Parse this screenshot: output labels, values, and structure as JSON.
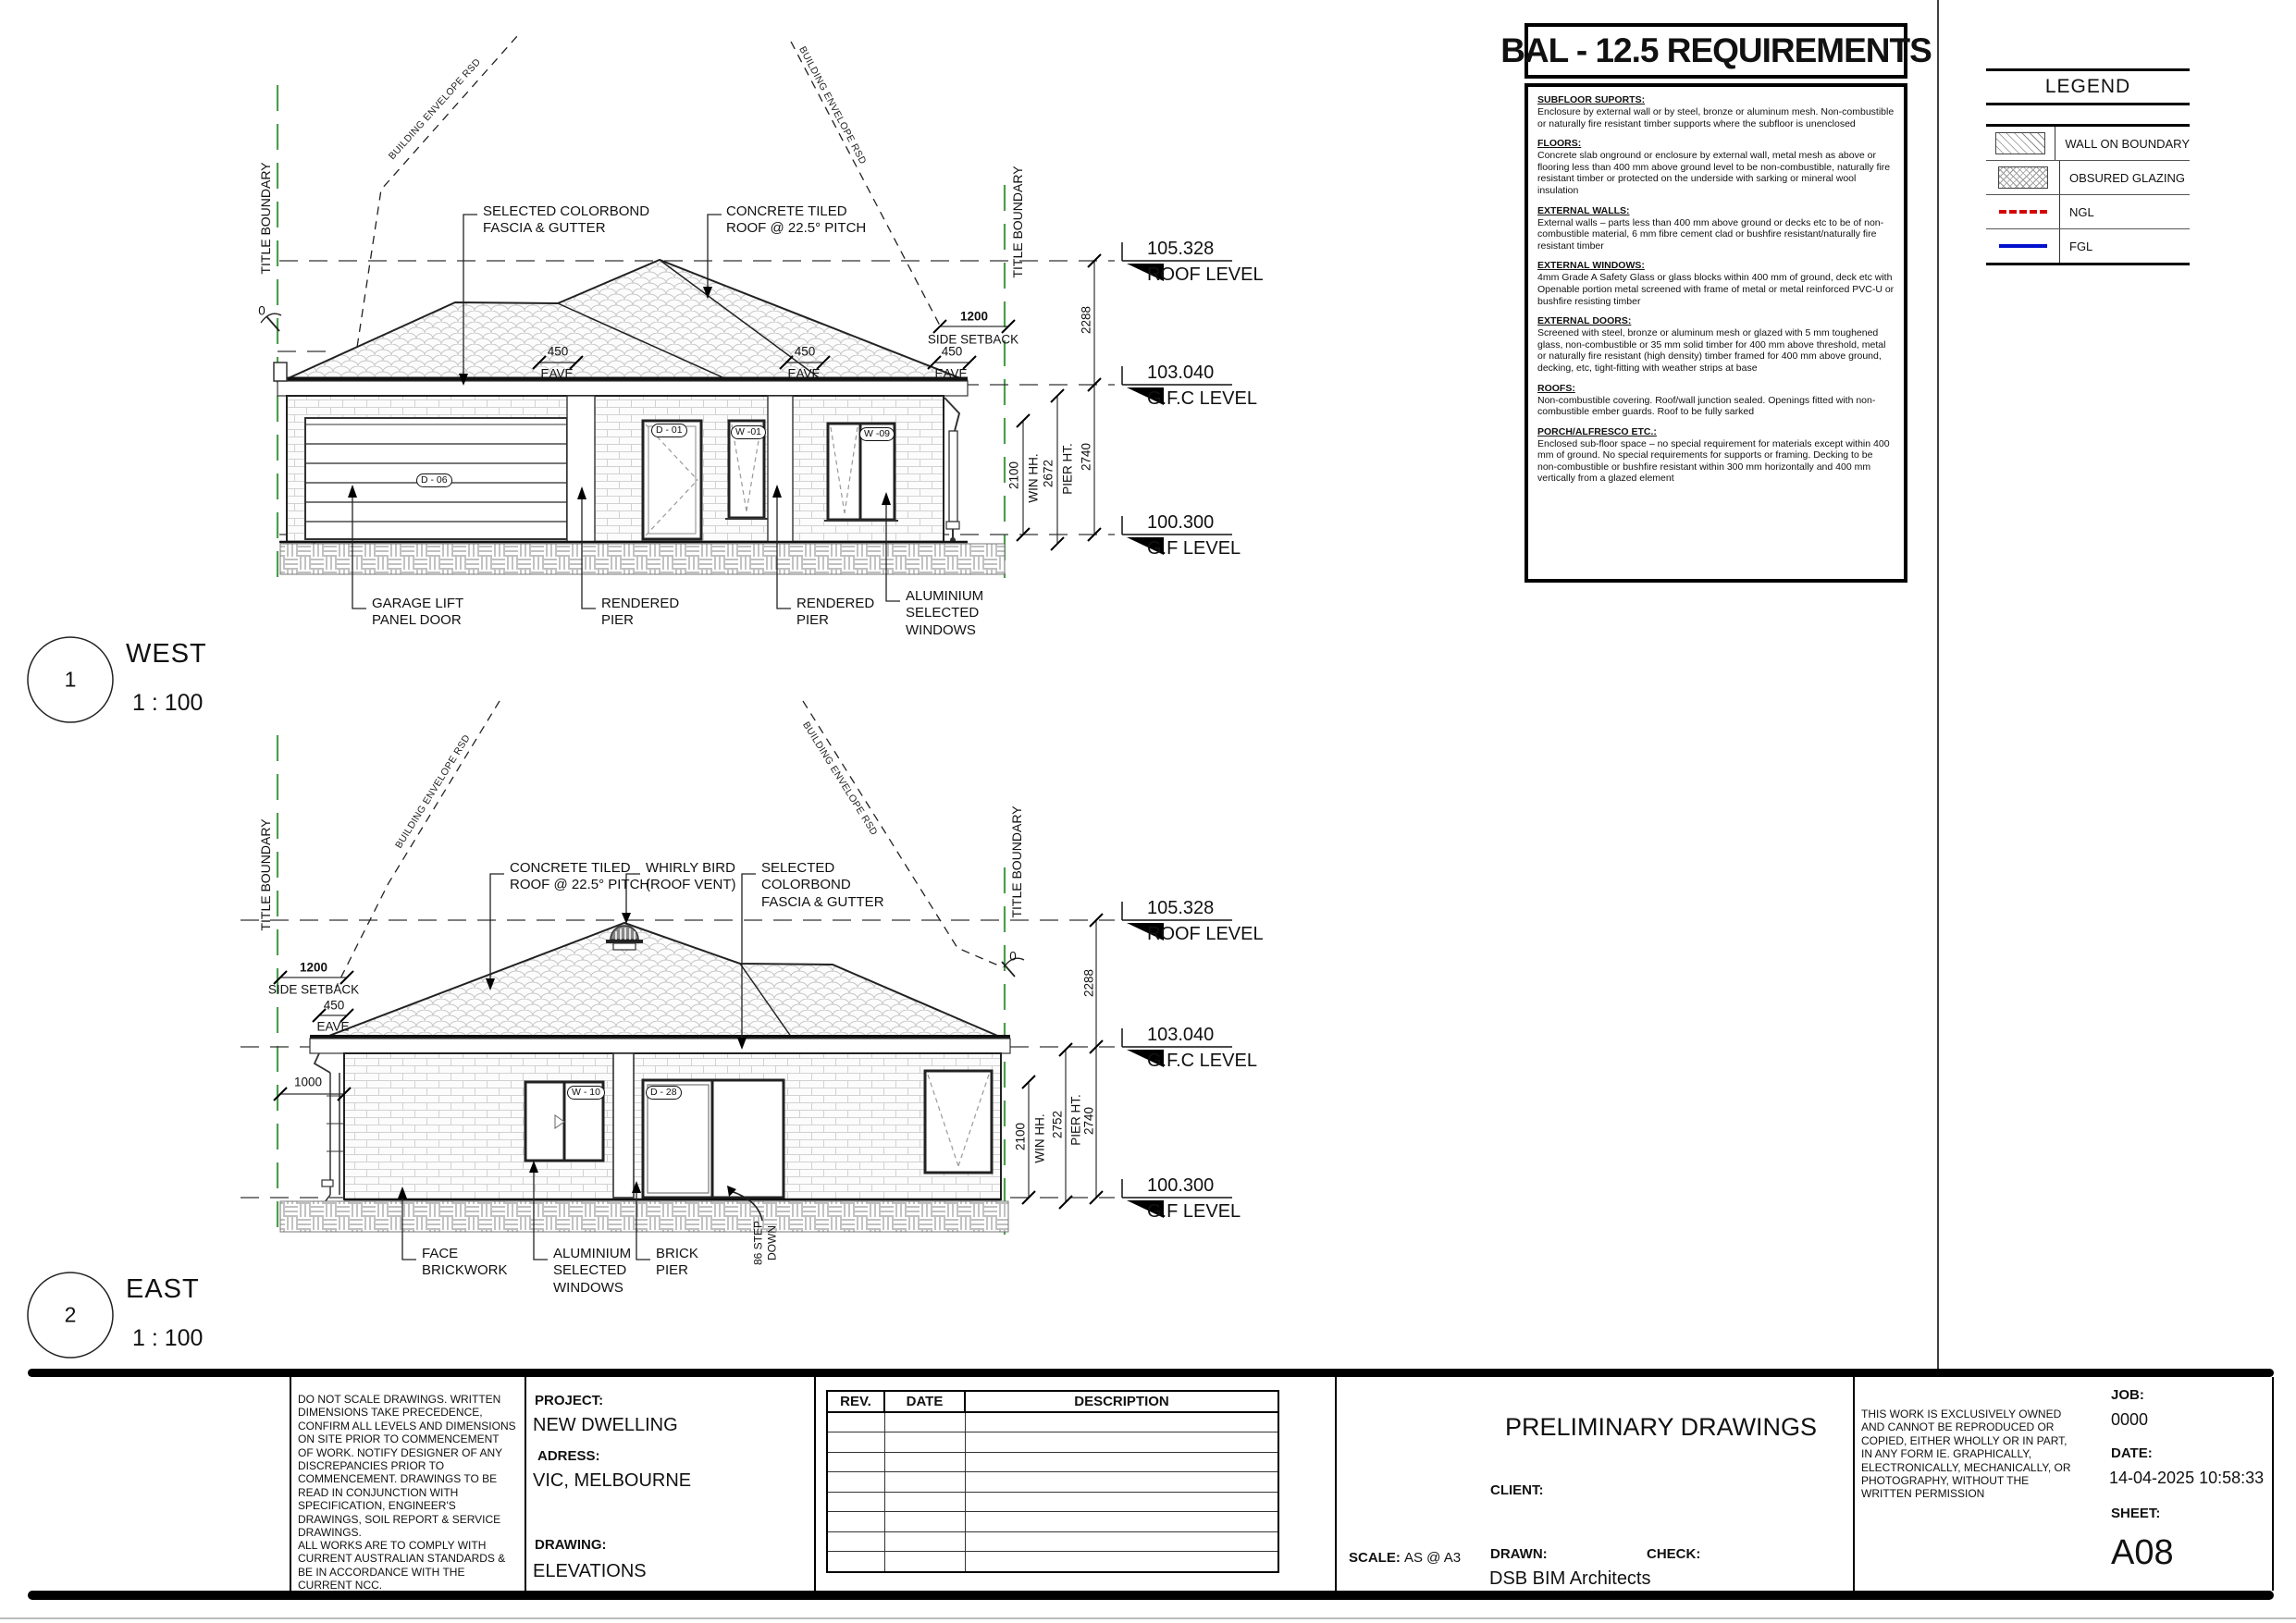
{
  "bal": {
    "title": "BAL - 12.5 REQUIREMENTS",
    "sections": [
      {
        "heading": "SUBFLOOR SUPORTS:",
        "body": "Enclosure by external wall or by steel, bronze or aluminum mesh. Non-combustible or naturally fire resistant timber supports where the subfloor is unenclosed"
      },
      {
        "heading": "FLOORS:",
        "body": "Concrete slab onground or enclosure by external wall, metal mesh as above or flooring less than 400 mm above ground level to be non-combustible, naturally fire resistant timber or protected on the underside with sarking or mineral wool insulation"
      },
      {
        "heading": "EXTERNAL WALLS:",
        "body": "External walls – parts less than 400 mm above ground or decks etc to be of non-combustible material, 6 mm fibre cement clad or bushfire resistant/naturally fire resistant timber"
      },
      {
        "heading": "EXTERNAL WINDOWS:",
        "body": "4mm Grade A Safety Glass or glass blocks within 400 mm of ground, deck etc with Openable portion metal screened with frame of metal or metal reinforced PVC-U or bushfire resisting timber"
      },
      {
        "heading": "EXTERNAL DOORS:",
        "body": "Screened with steel, bronze or aluminum mesh or glazed with 5 mm toughened glass, non-combustible or 35 mm solid timber for 400 mm above threshold, metal or naturally fire resistant (high density) timber framed for 400 mm above ground, decking, etc, tight-fitting with weather strips at base"
      },
      {
        "heading": "ROOFS:",
        "body": "Non-combustible covering. Roof/wall junction sealed. Openings fitted with non-combustible ember guards. Roof to be fully sarked"
      },
      {
        "heading": "PORCH/ALFRESCO ETC.:",
        "body": "Enclosed sub-floor space – no special requirement for materials except within 400 mm of ground. No special requirements for supports or framing. Decking to be non-combustible or bushfire resistant within 300 mm horizontally and 400 mm vertically from a glazed element"
      }
    ]
  },
  "legend": {
    "title": "LEGEND",
    "items": [
      {
        "label": "WALL ON BOUNDARY",
        "swatch": "diagonal-hatch"
      },
      {
        "label": "OBSURED GLAZING",
        "swatch": "cross-hatch"
      },
      {
        "label": "NGL",
        "swatch": "red-dashed-line",
        "color": "#d40000"
      },
      {
        "label": "FGL",
        "swatch": "blue-solid-line",
        "color": "#0010cc"
      }
    ]
  },
  "levels": {
    "roof": {
      "value": "105.328",
      "label": "ROOF LEVEL"
    },
    "gfc": {
      "value": "103.040",
      "label": "G.F.C LEVEL"
    },
    "gf": {
      "value": "100.300",
      "label": "G.F LEVEL"
    }
  },
  "common": {
    "title_boundary": "TITLE BOUNDARY",
    "building_envelope": "BUILDING ENVELOPE RSD",
    "zero": "0",
    "win_hh_label": "WIN HH.",
    "pier_ht_label": "PIER HT.",
    "setback_label": "SIDE SETBACK",
    "eave_label": "EAVE",
    "d2288": "2288",
    "d2740": "2740",
    "d2100": "2100",
    "d450": "450",
    "d1200": "1200"
  },
  "west": {
    "number": "1",
    "name": "WEST",
    "scale": "1 : 100",
    "pier_ht": "2672",
    "labels": {
      "colorbond": "SELECTED COLORBOND\nFASCIA & GUTTER",
      "roof": "CONCRETE TILED\nROOF @ 22.5° PITCH",
      "garage": "GARAGE LIFT\nPANEL DOOR",
      "pier": "RENDERED\nPIER",
      "windows": "ALUMINIUM\nSELECTED\nWINDOWS"
    },
    "tags": {
      "garage": "D - 06",
      "door": "D - 01",
      "w01": "W -01",
      "w09": "W -09"
    }
  },
  "east": {
    "number": "2",
    "name": "EAST",
    "scale": "1 : 100",
    "pier_ht": "2752",
    "d1000": "1000",
    "labels": {
      "roof": "CONCRETE TILED\nROOF @ 22.5° PITCH",
      "whirly": "WHIRLY BIRD\n(ROOF VENT)",
      "colorbond": "SELECTED\nCOLORBOND\nFASCIA & GUTTER",
      "brick": "FACE\nBRICKWORK",
      "windows": "ALUMINIUM\nSELECTED\nWINDOWS",
      "pier": "BRICK\nPIER",
      "step": "86 STEP\nDOWN"
    },
    "tags": {
      "w10": "W - 10",
      "d28": "D - 28"
    }
  },
  "titleblock": {
    "notes1": "DO NOT SCALE DRAWINGS. WRITTEN DIMENSIONS TAKE PRECEDENCE, CONFIRM ALL LEVELS AND DIMENSIONS ON SITE PRIOR TO COMMENCEMENT OF WORK. NOTIFY DESIGNER OF ANY DISCREPANCIES PRIOR TO COMMENCEMENT. DRAWINGS TO BE READ IN CONJUNCTION WITH SPECIFICATION, ENGINEER'S DRAWINGS, SOIL REPORT & SERVICE DRAWINGS.",
    "notes2": "ALL WORKS ARE TO COMPLY WITH CURRENT AUSTRALIAN STANDARDS & BE IN ACCORDANCE WITH THE CURRENT NCC.",
    "project_label": "PROJECT:",
    "project": "NEW DWELLING",
    "address_label": "ADRESS:",
    "address": "VIC, MELBOURNE",
    "drawing_label": "DRAWING:",
    "drawing": "ELEVATIONS",
    "rev_header": "REV.",
    "date_header": "DATE",
    "description_header": "DESCRIPTION",
    "status": "PRELIMINARY DRAWINGS",
    "client_label": "CLIENT:",
    "scale_label": "SCALE:",
    "scale": "AS @ A3",
    "drawn_label": "DRAWN:",
    "drawn": "DSB BIM Architects",
    "check_label": "CHECK:",
    "copyright": "THIS WORK IS EXCLUSIVELY OWNED AND CANNOT BE REPRODUCED OR COPIED, EITHER WHOLLY OR IN PART, IN ANY FORM IE. GRAPHICALLY, ELECTRONICALLY, MECHANICALLY, OR PHOTOGRAPHY, WITHOUT THE WRITTEN PERMISSION",
    "job_label": "JOB:",
    "job": "0000",
    "date_label": "DATE:",
    "datetime": "14-04-2025 10:58:33",
    "sheet_label": "SHEET:",
    "sheet": "A08"
  }
}
